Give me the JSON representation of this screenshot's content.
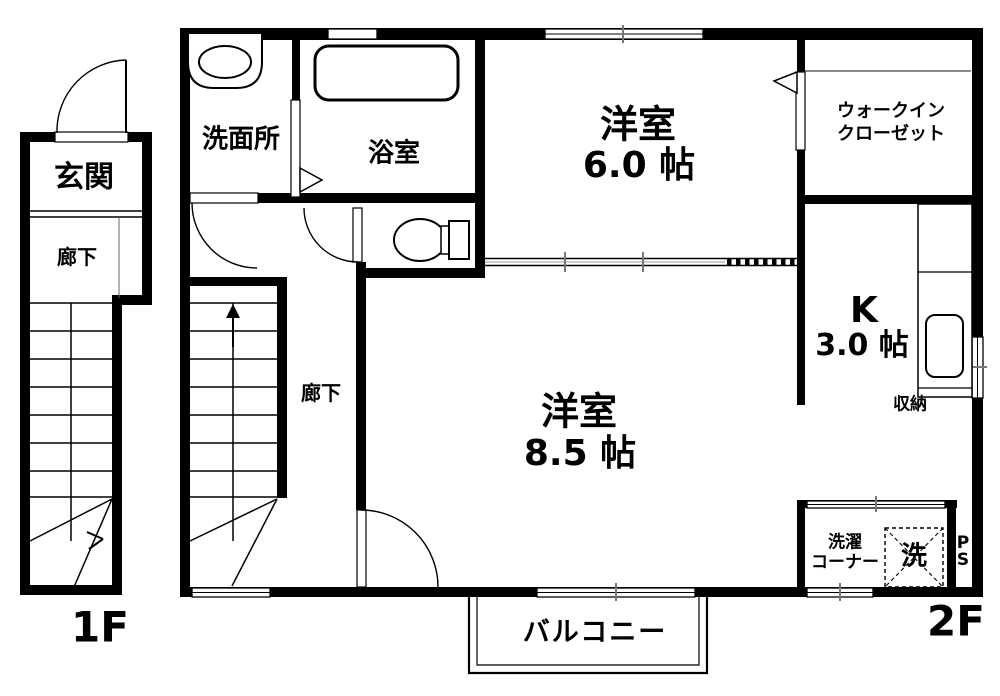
{
  "palette": {
    "ink": "#000000",
    "paper": "#ffffff",
    "tick_gray": "#777777"
  },
  "floor1": {
    "floor_label": "1F",
    "genkan": "玄関",
    "rouka": "廊下"
  },
  "floor2": {
    "floor_label": "2F",
    "senmenjo": "洗面所",
    "yokushitsu": "浴室",
    "yoshitsu6_name": "洋室",
    "yoshitsu6_size": "6.0 帖",
    "wic": "ウォークイン\nクローゼット",
    "kitchen_name": "K",
    "kitchen_size": "3.0 帖",
    "shuno": "収納",
    "rouka": "廊下",
    "yoshitsu85_name": "洋室",
    "yoshitsu85_size": "8.5 帖",
    "sentaku_corner": "洗濯\nコーナー",
    "washer": "洗",
    "ps": "P\nS",
    "balcony": "バルコニー"
  }
}
